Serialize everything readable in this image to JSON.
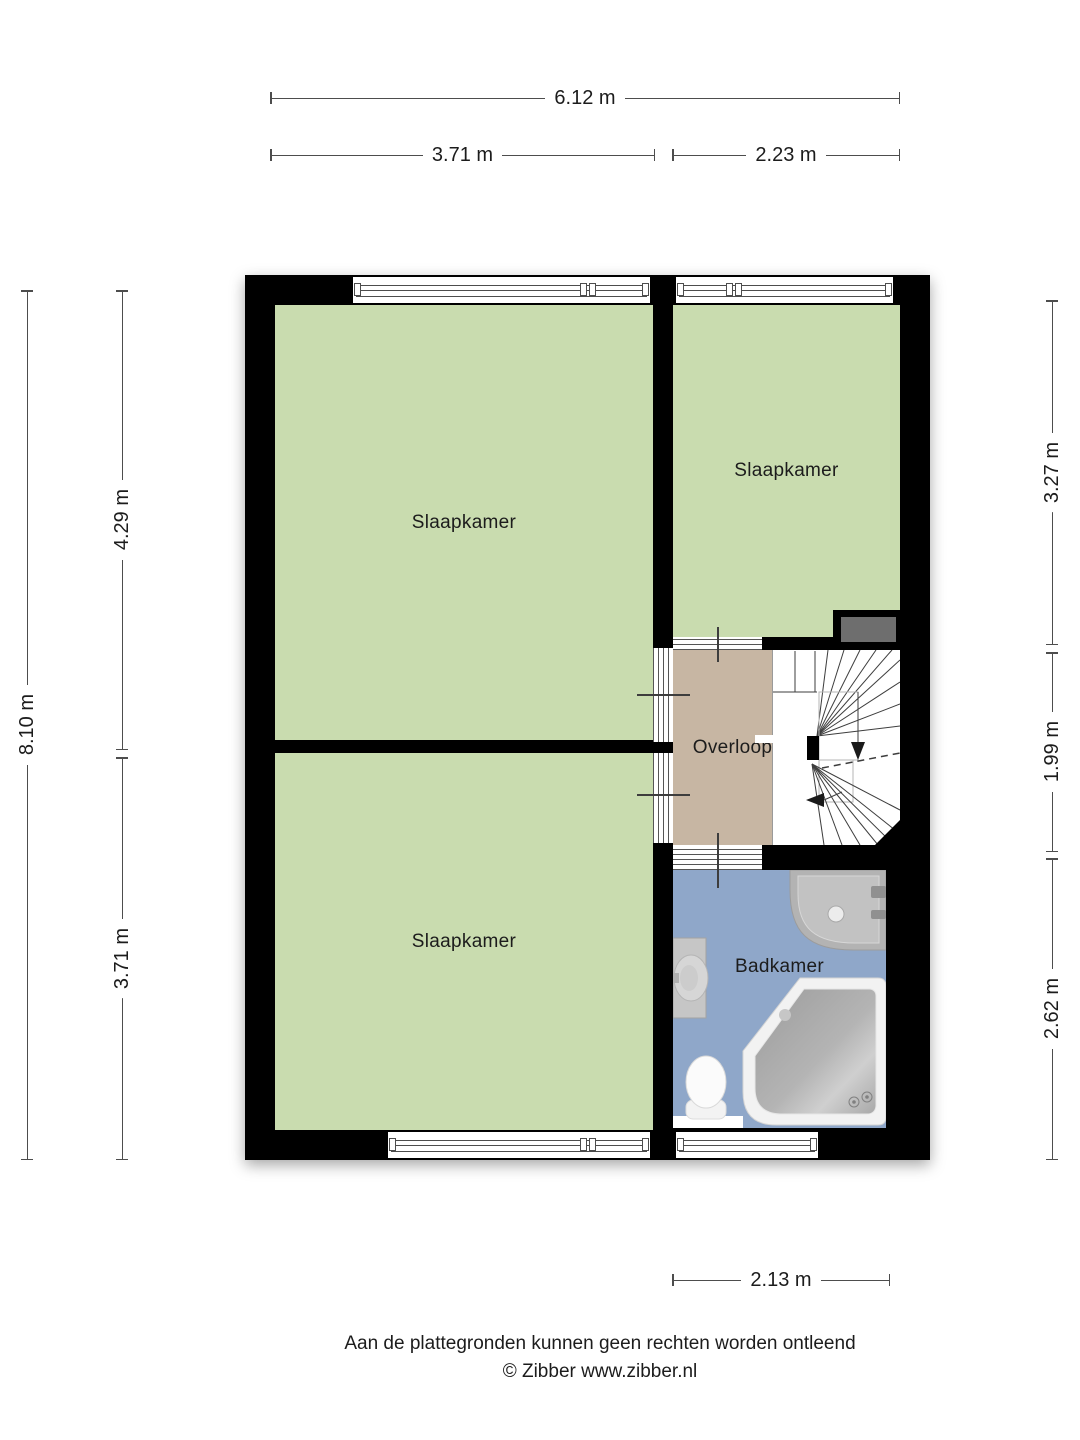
{
  "dimensions": {
    "top_total": "6.12 m",
    "top_left": "3.71 m",
    "top_right": "2.23 m",
    "left_total": "8.10 m",
    "left_upper": "4.29 m",
    "left_lower": "3.71 m",
    "right_upper": "3.27 m",
    "right_middle": "1.99 m",
    "right_lower": "2.62 m",
    "bottom": "2.13 m"
  },
  "rooms": {
    "bedroom_top_left": {
      "label": "Slaapkamer"
    },
    "bedroom_bottom_left": {
      "label": "Slaapkamer"
    },
    "bedroom_right": {
      "label": "Slaapkamer"
    },
    "landing": {
      "label": "Overloop"
    },
    "bathroom": {
      "label": "Badkamer"
    }
  },
  "footer": {
    "disclaimer": "Aan de plattegronden kunnen geen rechten worden ontleend",
    "copyright": "© Zibber www.zibber.nl"
  },
  "colors": {
    "wall": "#000000",
    "room_green": "#c9dcaf",
    "landing_tan": "#c7b6a3",
    "bathroom_blue": "#8fa7c9",
    "closet_gray": "#6e6e6e",
    "dim_line": "#4d4d4d",
    "text": "#1c1c1c"
  }
}
